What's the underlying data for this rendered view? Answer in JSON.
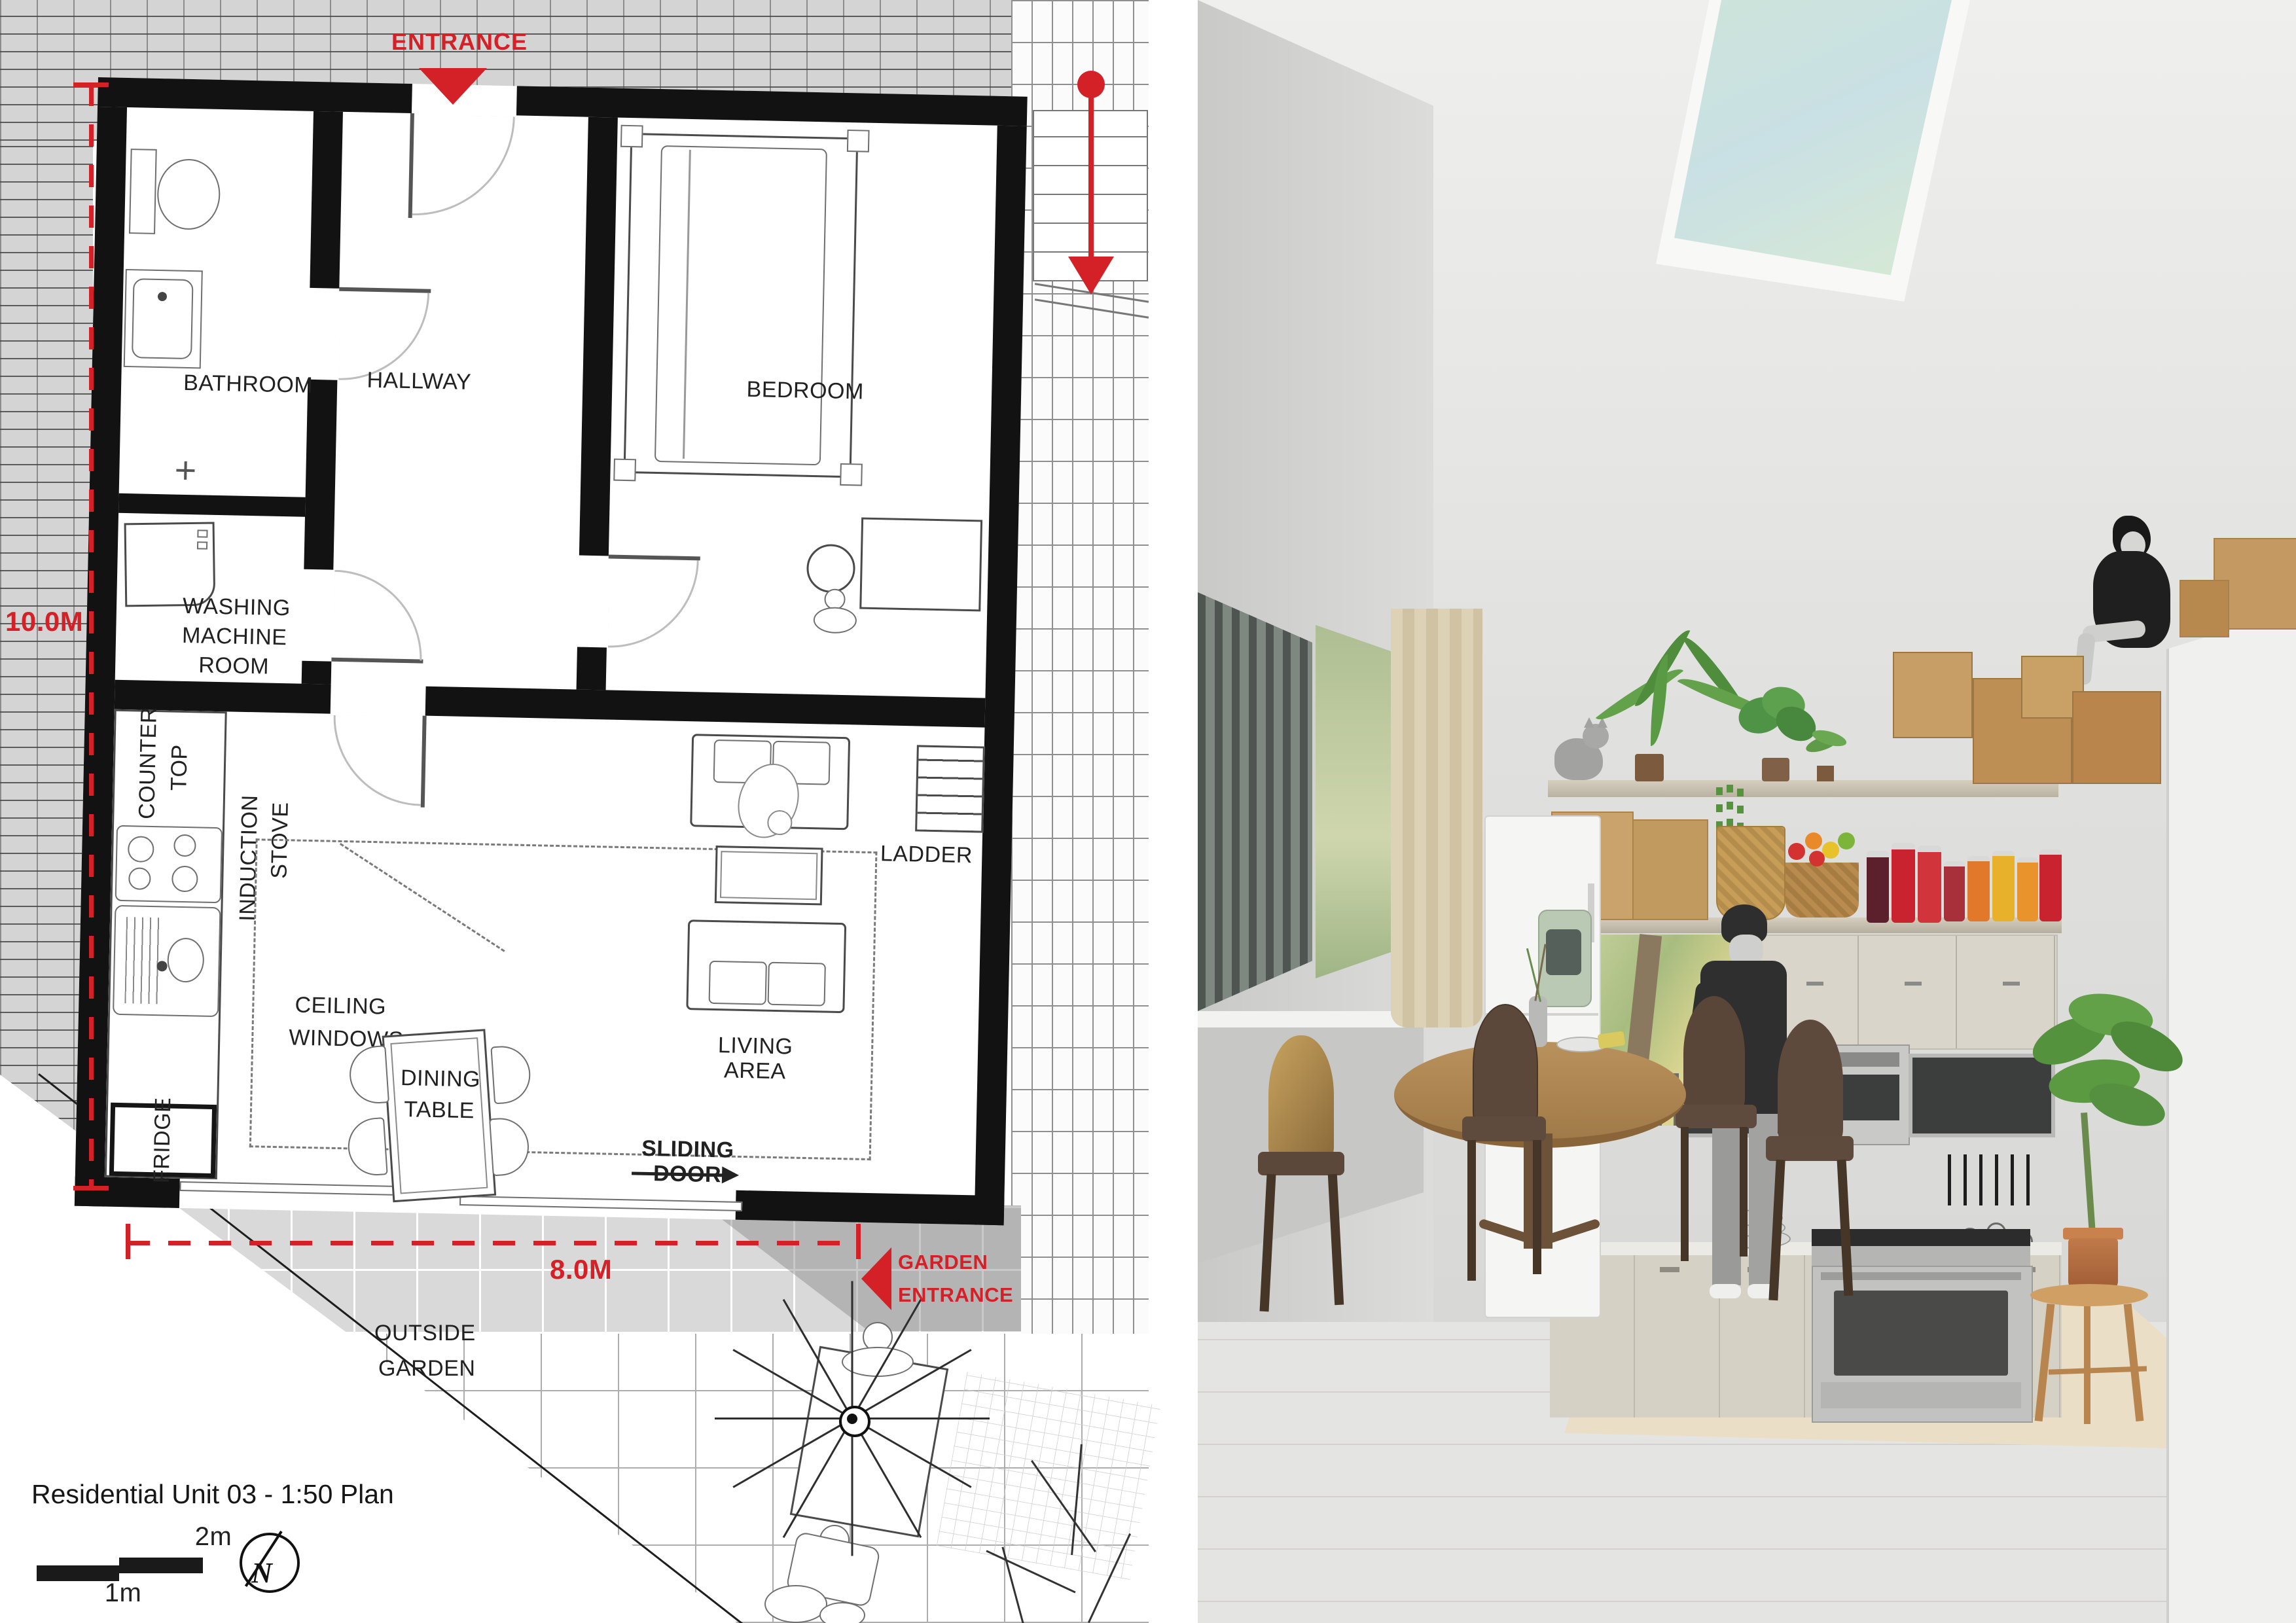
{
  "plan": {
    "title": "Residential Unit 03 - 1:50 Plan",
    "entrance": {
      "label": "ENTRANCE"
    },
    "garden_entrance": {
      "line1": "GARDEN",
      "line2": "ENTRANCE"
    },
    "dimensions": {
      "height": "10.0M",
      "width": "8.0M"
    },
    "rooms": {
      "bathroom": "BATHROOM",
      "hallway": "HALLWAY",
      "bedroom": "BEDROOM",
      "washing_line1": "WASHING",
      "washing_line2": "MACHINE",
      "washing_line3": "ROOM",
      "living": "LIVING AREA"
    },
    "kitchen": {
      "counter_line1": "COUNTER",
      "counter_line2": "TOP",
      "induction_line1": "INDUCTION",
      "induction_line2": "STOVE",
      "fridge": "FRIDGE"
    },
    "annotations": {
      "ceiling_line1": "CEILING",
      "ceiling_line2": "WINDOWS",
      "dining_line1": "DINING",
      "dining_line2": "TABLE",
      "ladder": "LADDER",
      "sliding_door": "SLIDING DOOR",
      "outside_line1": "OUTSIDE",
      "outside_line2": "GARDEN"
    },
    "scale_bar": {
      "half": "1m",
      "full": "2m"
    },
    "compass": {
      "north": "N"
    },
    "colors": {
      "annotation_red": "#d42127",
      "wall_black": "#121212",
      "brick_grey": "#d4d4d4",
      "paver_grey": "#d9d9d9"
    }
  },
  "rendering": {
    "colors": {
      "wall": "#dedddb",
      "floor": "#d2c1aa",
      "rug": "#eadfc6",
      "skylight_sky": "#cde4da",
      "chair_wood": "#5c483a",
      "table_wood": "#b08a58",
      "plant_green": "#5f9a48",
      "box_cardboard": "#c2955e",
      "curtain": "#d9cdae"
    }
  }
}
